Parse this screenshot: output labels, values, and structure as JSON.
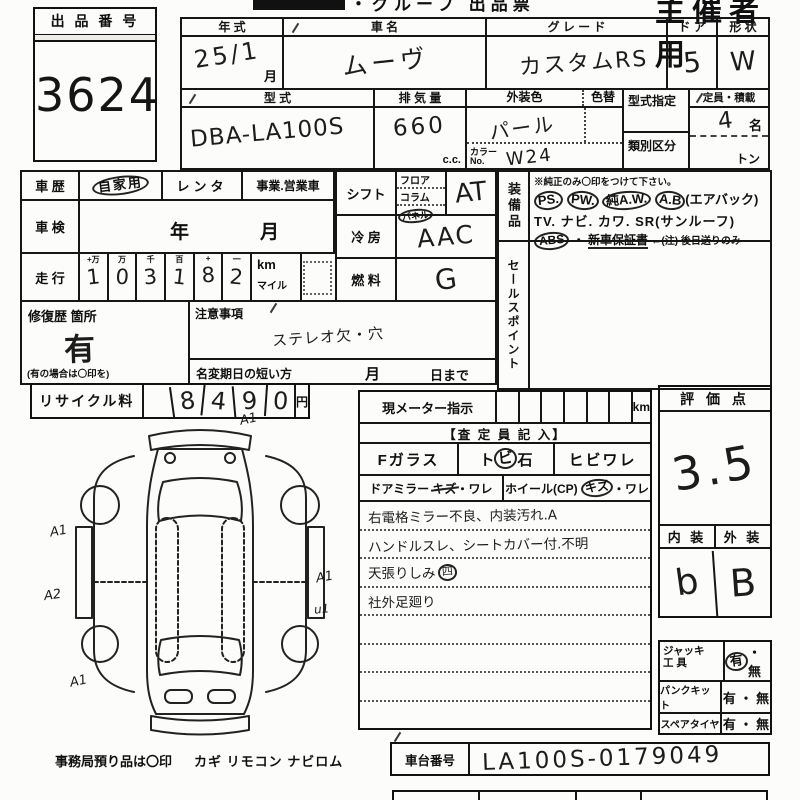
{
  "header": {
    "title": "・グループ 出品票",
    "right": "主催者用"
  },
  "lot": {
    "label": "出 品 番 号",
    "number": "3624"
  },
  "vehicle": {
    "year_label": "年    式",
    "year_value": "25/1",
    "month_suffix": "月",
    "name_label": "車    名",
    "name_value": "ムーヴ",
    "grade_label": "グ レ ー ド",
    "grade_value": "カスタムRS",
    "door_label": "ド ア",
    "door_value": "5",
    "shape_label": "形 状",
    "shape_value": "W",
    "model_label": "型    式",
    "model_value": "DBA-LA100S",
    "disp_label": "排 気 量",
    "disp_value": "660",
    "disp_unit": "c.c.",
    "color_label": "外装色",
    "color_value": "パール",
    "color_change_label": "色替",
    "color_no_label": "カラーNo.",
    "color_no_value": "W24",
    "type_desig_label": "型式指定",
    "class_label": "類別区分",
    "capacity_label": "定員・積載",
    "capacity_value": "4",
    "capacity_unit": "名",
    "load_unit": "トン"
  },
  "history": {
    "label": "車 歴",
    "opt1": "自家用",
    "opt2": "レンタ",
    "opt3": "事業.営業車"
  },
  "inspection": {
    "label": "車 検",
    "year": "年",
    "month": "月"
  },
  "mileage": {
    "label": "走 行",
    "h1": "+万",
    "h2": "万",
    "h3": "千",
    "h4": "百",
    "h5": "+",
    "h6": "一",
    "d1": "1",
    "d2": "0",
    "d3": "3",
    "d4": "1",
    "d5": "8",
    "d6": "2",
    "km": "km",
    "mile": "マイル"
  },
  "shift": {
    "label": "シフト",
    "opt1": "フロア",
    "opt2": "コラム",
    "opt3": "パネル",
    "value": "AT"
  },
  "ac": {
    "label": "冷 房",
    "value": "AAC"
  },
  "fuel": {
    "label": "燃 料",
    "value": "G"
  },
  "equipment": {
    "label": "装備品",
    "note": "※純正のみ〇印をつけて下さい。",
    "ps": "PS.",
    "pw": "PW.",
    "aw": "純A.W.",
    "ab": "A.B",
    "ab_paren": "(エアバック)",
    "line2": "TV. ナビ. カワ. SR(サンルーフ)",
    "abs": "ABS",
    "dot": "・",
    "warranty": "新車保証書",
    "warranty_note": "←(注) 後日送りのみ"
  },
  "sales_point": {
    "label": "セールスポイント"
  },
  "repair": {
    "label": "修復歴 箇所",
    "value": "有",
    "note": "(有の場合は〇印を)"
  },
  "caution": {
    "label": "注意事項",
    "value": "ステレオ欠・穴"
  },
  "rename": {
    "label": "名変期日の短い方",
    "month": "月",
    "day": "日まで"
  },
  "recycle": {
    "label": "リサイクル料",
    "d1": "8",
    "d2": "4",
    "d3": "9",
    "d4": "0",
    "unit": "円"
  },
  "meter": {
    "label": "現メーター指示",
    "unit": "km"
  },
  "assessor": {
    "header": "【査 定 員 記 入】",
    "fglass": "Fガラス",
    "tobi_pre": "ト",
    "tobi_mid": "ビ",
    "tobi_post": "石",
    "hibi": "ヒビワレ",
    "mirror_label": "ドアミラー",
    "mirror_kizu": "キズ",
    "mirror_ware": "・ワレ",
    "wheel_label": "ホイール(CP)",
    "wheel_kizu": "キズ",
    "wheel_ware": "・ワレ",
    "c1": "右電格ミラー不良、内装汚れ.A",
    "c2": "ハンドルスレ、シートカバー付.不明",
    "c3": "天張りしみ",
    "c3_circled": "四",
    "c4": "社外足廻り"
  },
  "score": {
    "label": "評 価 点",
    "value": "3.5",
    "interior_label": "内 装",
    "interior_value": "b",
    "exterior_label": "外 装",
    "exterior_value": "B"
  },
  "tools": {
    "jack_l1": "ジャッキ",
    "jack_l2": "工  具",
    "jack_yes": "有",
    "jack_rest": "・ 無",
    "punk_label": "パンクキット",
    "punk_value": "有 ・ 無",
    "spare_label": "スペアタイヤ",
    "spare_value": "有 ・ 無"
  },
  "chassis": {
    "label": "車台番号",
    "value": "LA100S-0179049"
  },
  "office": {
    "note": "事務局預り品は〇印",
    "items": "カギ  リモコン  ナビロム"
  },
  "diagram": {
    "m1": "A1",
    "m2": "A1",
    "m3": "A2",
    "m4": "A1",
    "m5": "u1",
    "m6": "A1"
  }
}
